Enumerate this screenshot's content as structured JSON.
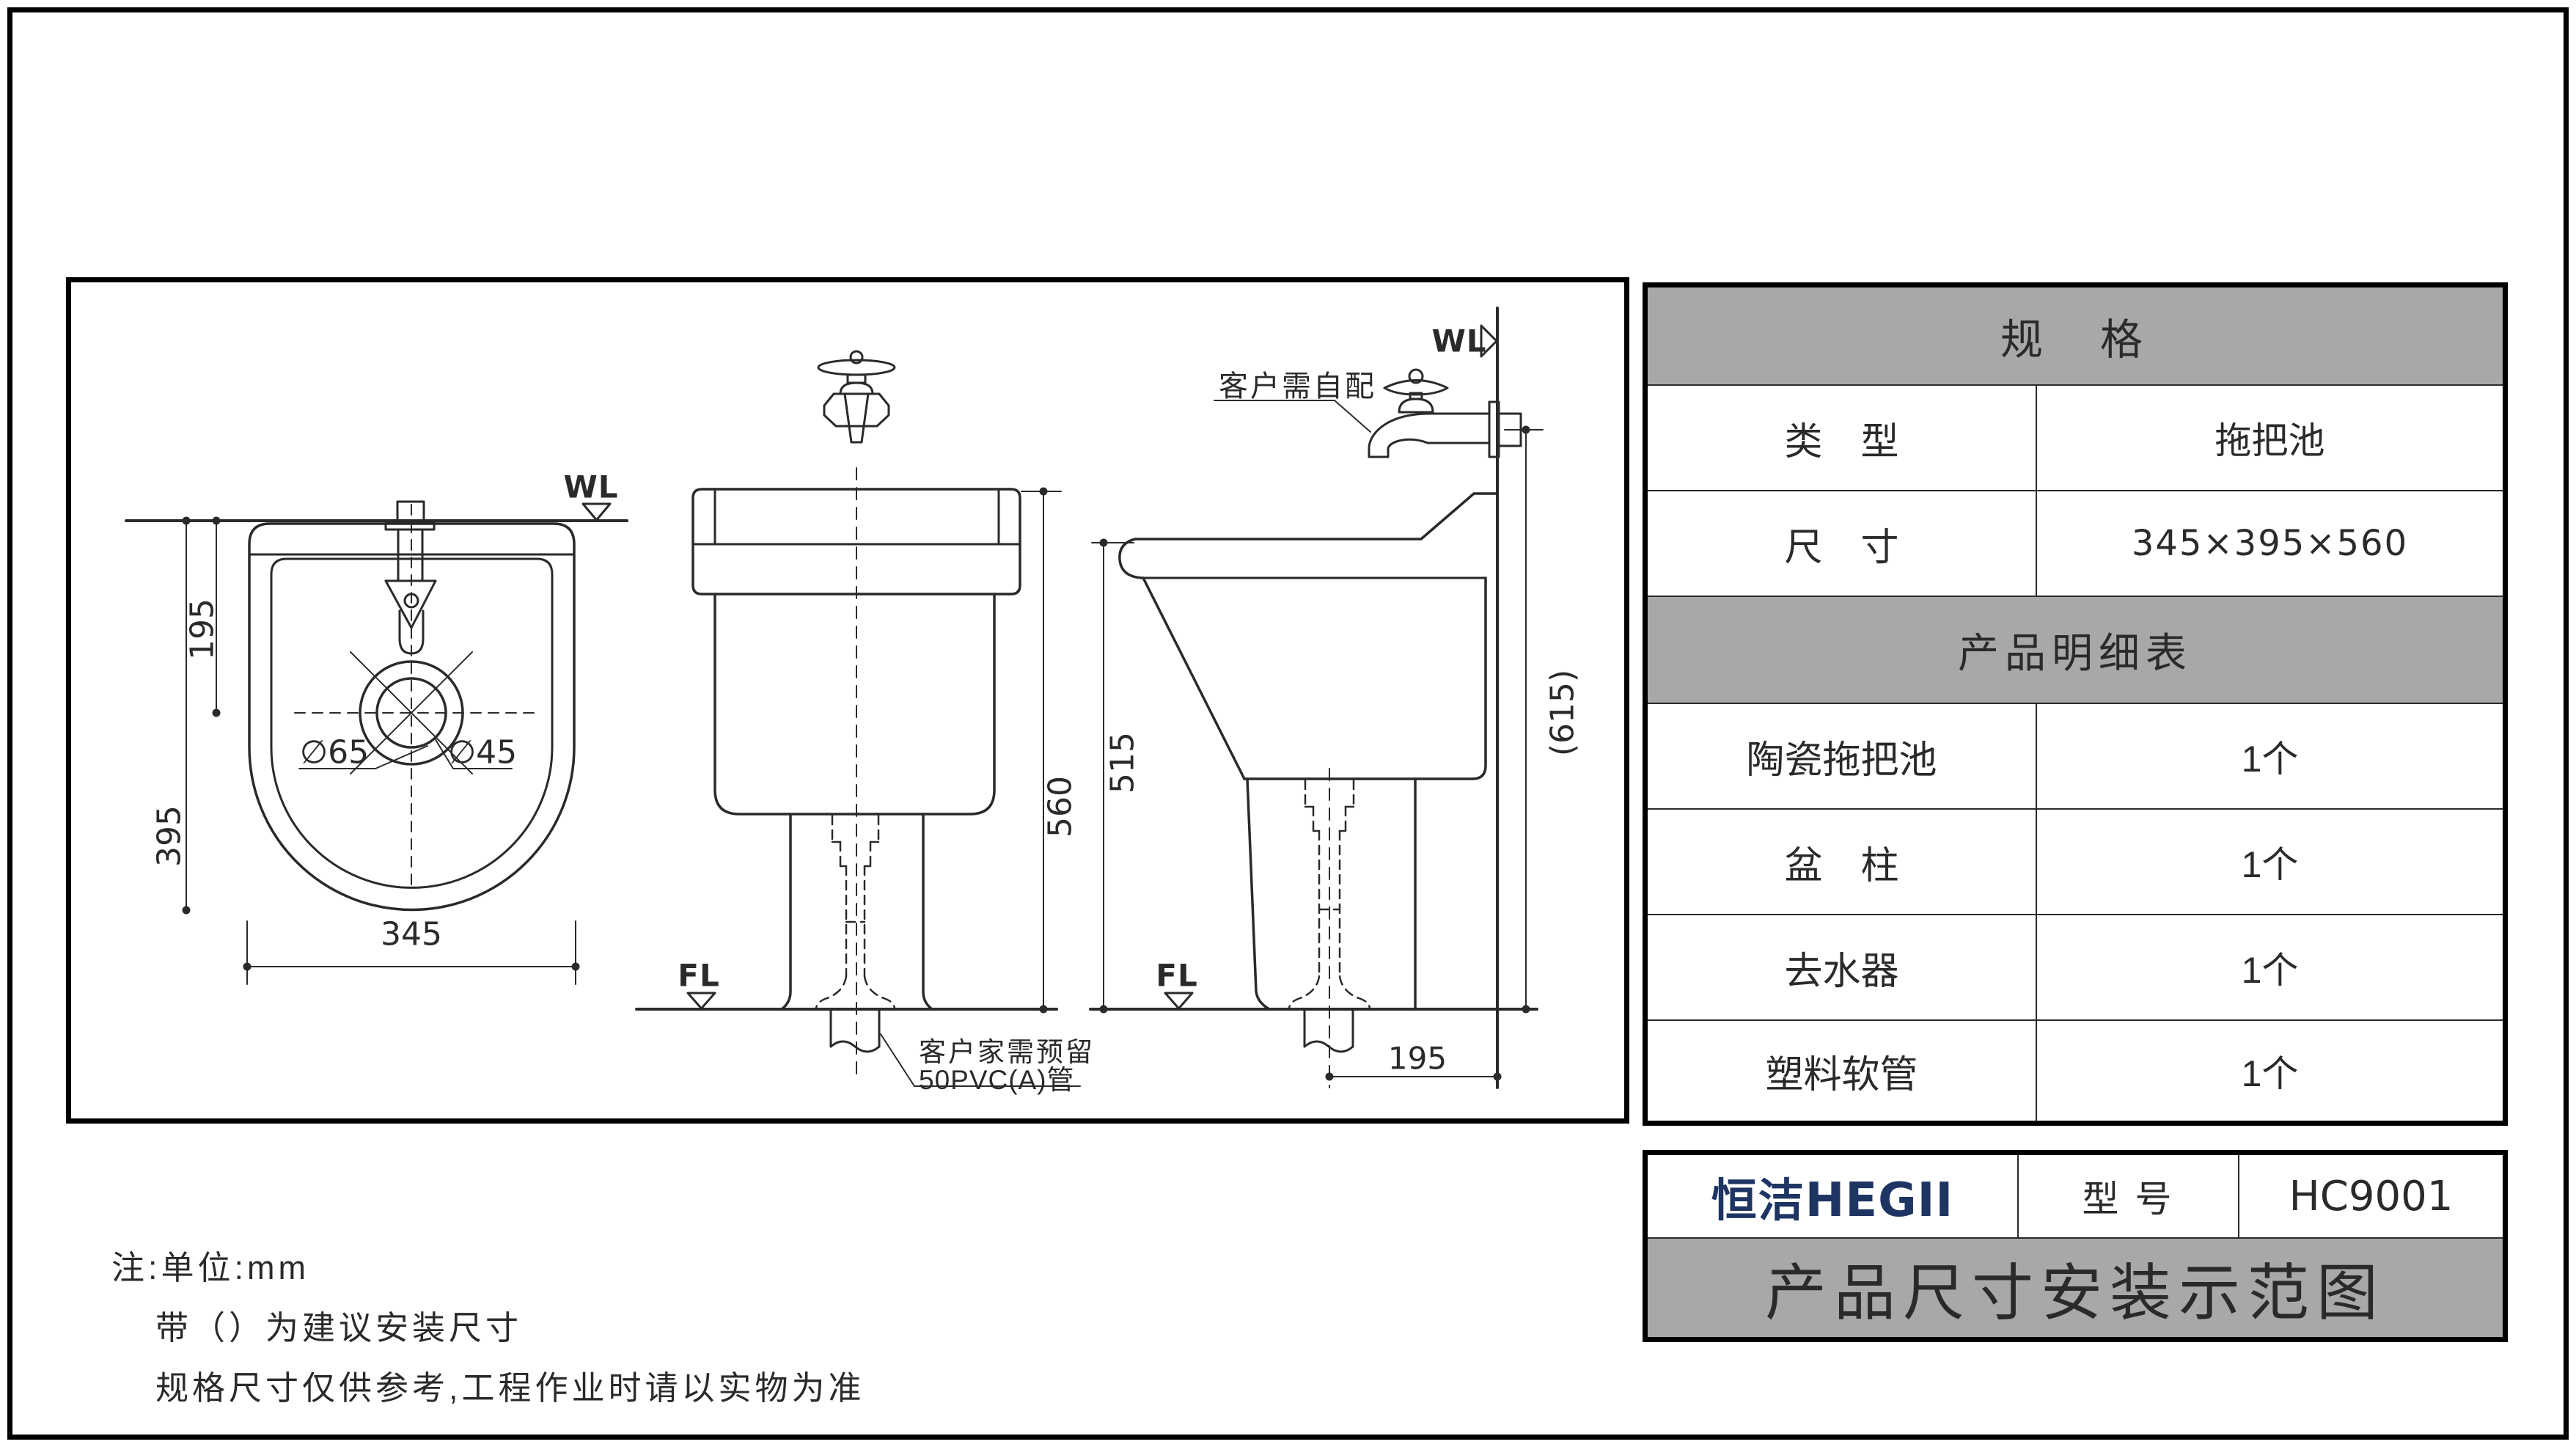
{
  "colors": {
    "accent_navy": "#1e3563",
    "header_gray": "#a8a8a8",
    "line": "#2b2a29"
  },
  "spec_table": {
    "header": "规　格",
    "rows": [
      {
        "label": "类　型",
        "value": "拖把池"
      },
      {
        "label": "尺　寸",
        "value": "345×395×560"
      }
    ],
    "detail_header": "产品明细表",
    "detail_rows": [
      {
        "label": "陶瓷拖把池",
        "value": "1个"
      },
      {
        "label": "盆　柱",
        "value": "1个"
      },
      {
        "label": "去水器",
        "value": "1个"
      },
      {
        "label": "塑料软管",
        "value": "1个"
      }
    ]
  },
  "title_block": {
    "brand_cn": "恒洁",
    "brand_en": "HEGII",
    "model_label": "型 号",
    "model_value": "HC9001",
    "banner": "产品尺寸安装示范图"
  },
  "notes": {
    "line1": "注:单位:mm",
    "line2": "带（）为建议安装尺寸",
    "line3": "规格尺寸仅供参考,工程作业时请以实物为准"
  },
  "drawing": {
    "wl": "WL",
    "fl": "FL",
    "plan": {
      "width": "345",
      "height": "395",
      "drain_offset": "195",
      "drain_outer": "∅65",
      "drain_inner": "∅45"
    },
    "front": {
      "height": "560",
      "pipe_note_1": "客户家需预留",
      "pipe_note_2": "50PVC(A)管"
    },
    "side": {
      "height": "515",
      "install_height": "(615)",
      "drain_to_wall": "195",
      "faucet_note": "客户需自配"
    }
  }
}
